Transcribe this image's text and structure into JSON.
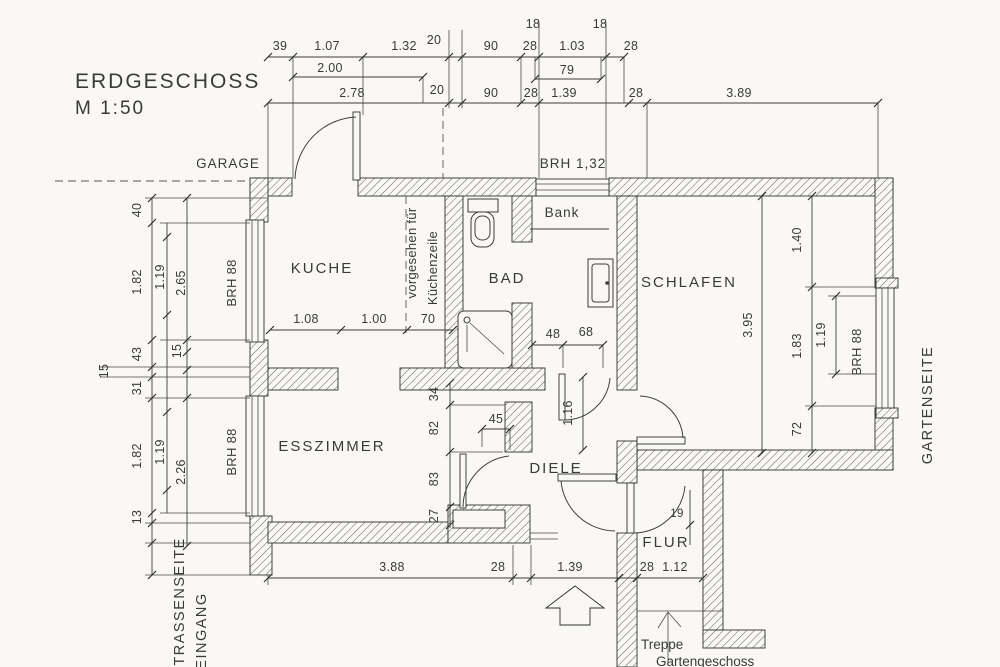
{
  "title": {
    "line1": "ERDGESCHOSS",
    "line2": "M 1:50"
  },
  "labels": {
    "garage": "GARAGE",
    "garden_side": "GARTENSEITE",
    "street_side": "STRASSENSEITE",
    "entrance": "EINGANG"
  },
  "dims_top": {
    "row1": [
      "39",
      "1.07",
      "1.32",
      "20",
      "90",
      "28",
      "1.03",
      "28"
    ],
    "row1_over": [
      "18",
      "18"
    ],
    "row2": [
      "2.00",
      "79"
    ],
    "row3": [
      "2.78",
      "20",
      "90",
      "28",
      "1.39",
      "28",
      "3.89"
    ]
  },
  "dims_left": {
    "outer": [
      "40",
      "1.82",
      "43",
      "15",
      "31",
      "1.82",
      "13"
    ],
    "mid": [
      "1.19",
      "15",
      "1.19"
    ],
    "inner": [
      "2.65",
      "2.26"
    ]
  },
  "rooms": {
    "kitchen": {
      "name": "KUCHE",
      "dims": [
        "1.08",
        "1.00",
        "70"
      ],
      "note1": "vorgesehen für",
      "note2": "Küchenzeile",
      "window": "BRH 88"
    },
    "bath": {
      "name": "BAD",
      "bench": "Bank",
      "window": "BRH 1,32",
      "dims": [
        "48",
        "68"
      ],
      "depth": "1.16"
    },
    "bedroom": {
      "name": "SCHLAFEN",
      "depth": "3.95",
      "right": [
        "1.40",
        "1.83",
        "72"
      ],
      "window_glass": "1.19",
      "window": "BRH 88"
    },
    "dining": {
      "name": "ESSZIMMER",
      "chain": [
        "34",
        "82",
        "83",
        "27"
      ],
      "niche": "45",
      "window": "BRH 88"
    },
    "hall": {
      "name": "DIELE",
      "door": "19"
    },
    "corridor": {
      "name": "FLUR",
      "stairs1": "Treppe",
      "stairs2": "Gartengeschoss"
    }
  },
  "dims_bottom": [
    "3.88",
    "28",
    "1.39",
    "28",
    "1.12"
  ]
}
